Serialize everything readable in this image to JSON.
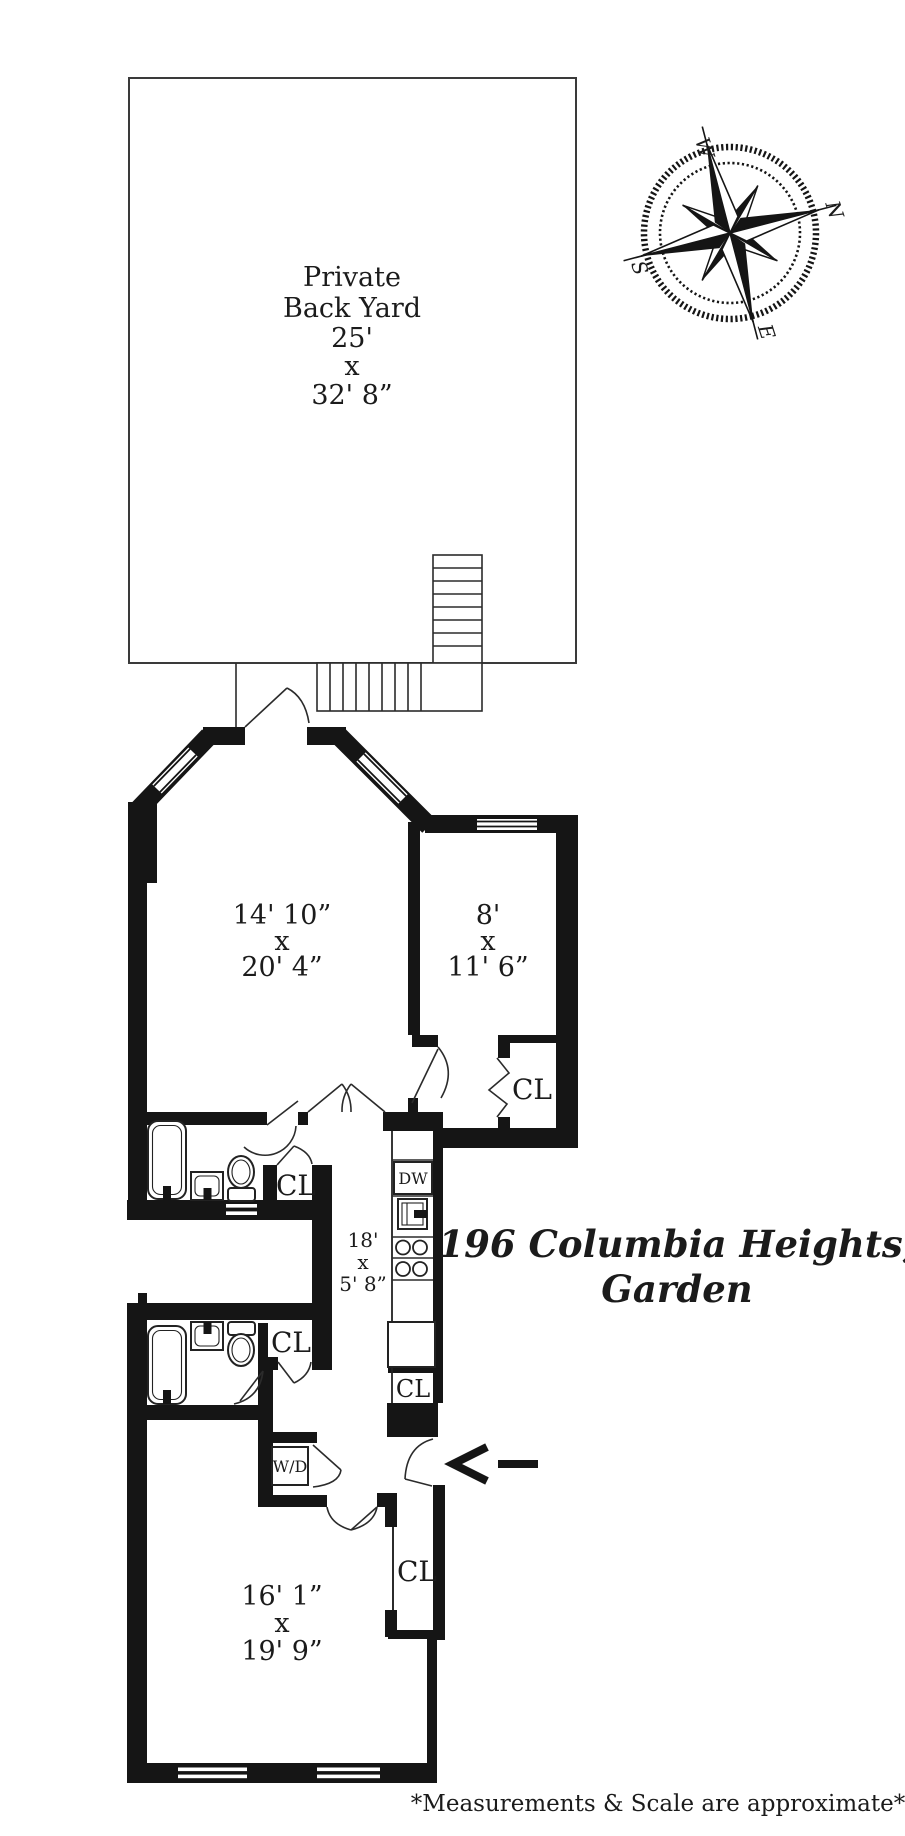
{
  "document": {
    "type": "floor-plan"
  },
  "title": {
    "line1": "196 Columbia Heights,",
    "line2": "Garden"
  },
  "footer": {
    "text": "*Measurements & Scale are approximate*"
  },
  "compass": {
    "n": "N",
    "e": "E",
    "s": "S",
    "w": "W"
  },
  "yard": {
    "lines": [
      "Private",
      "Back Yard",
      "25'",
      "x",
      "32' 8”"
    ]
  },
  "rooms": {
    "master": {
      "lines": [
        "14' 10”",
        "x",
        "20' 4”"
      ]
    },
    "bedroom2": {
      "lines": [
        "8'",
        "x",
        "11' 6”"
      ]
    },
    "hall": {
      "lines": [
        "18'",
        "x",
        "5' 8”"
      ]
    },
    "living": {
      "lines": [
        "16' 1”",
        "x",
        "19' 9”"
      ]
    }
  },
  "labels": {
    "closet": "CL",
    "dishwasher": "DW",
    "washer_dryer": "W/D"
  }
}
